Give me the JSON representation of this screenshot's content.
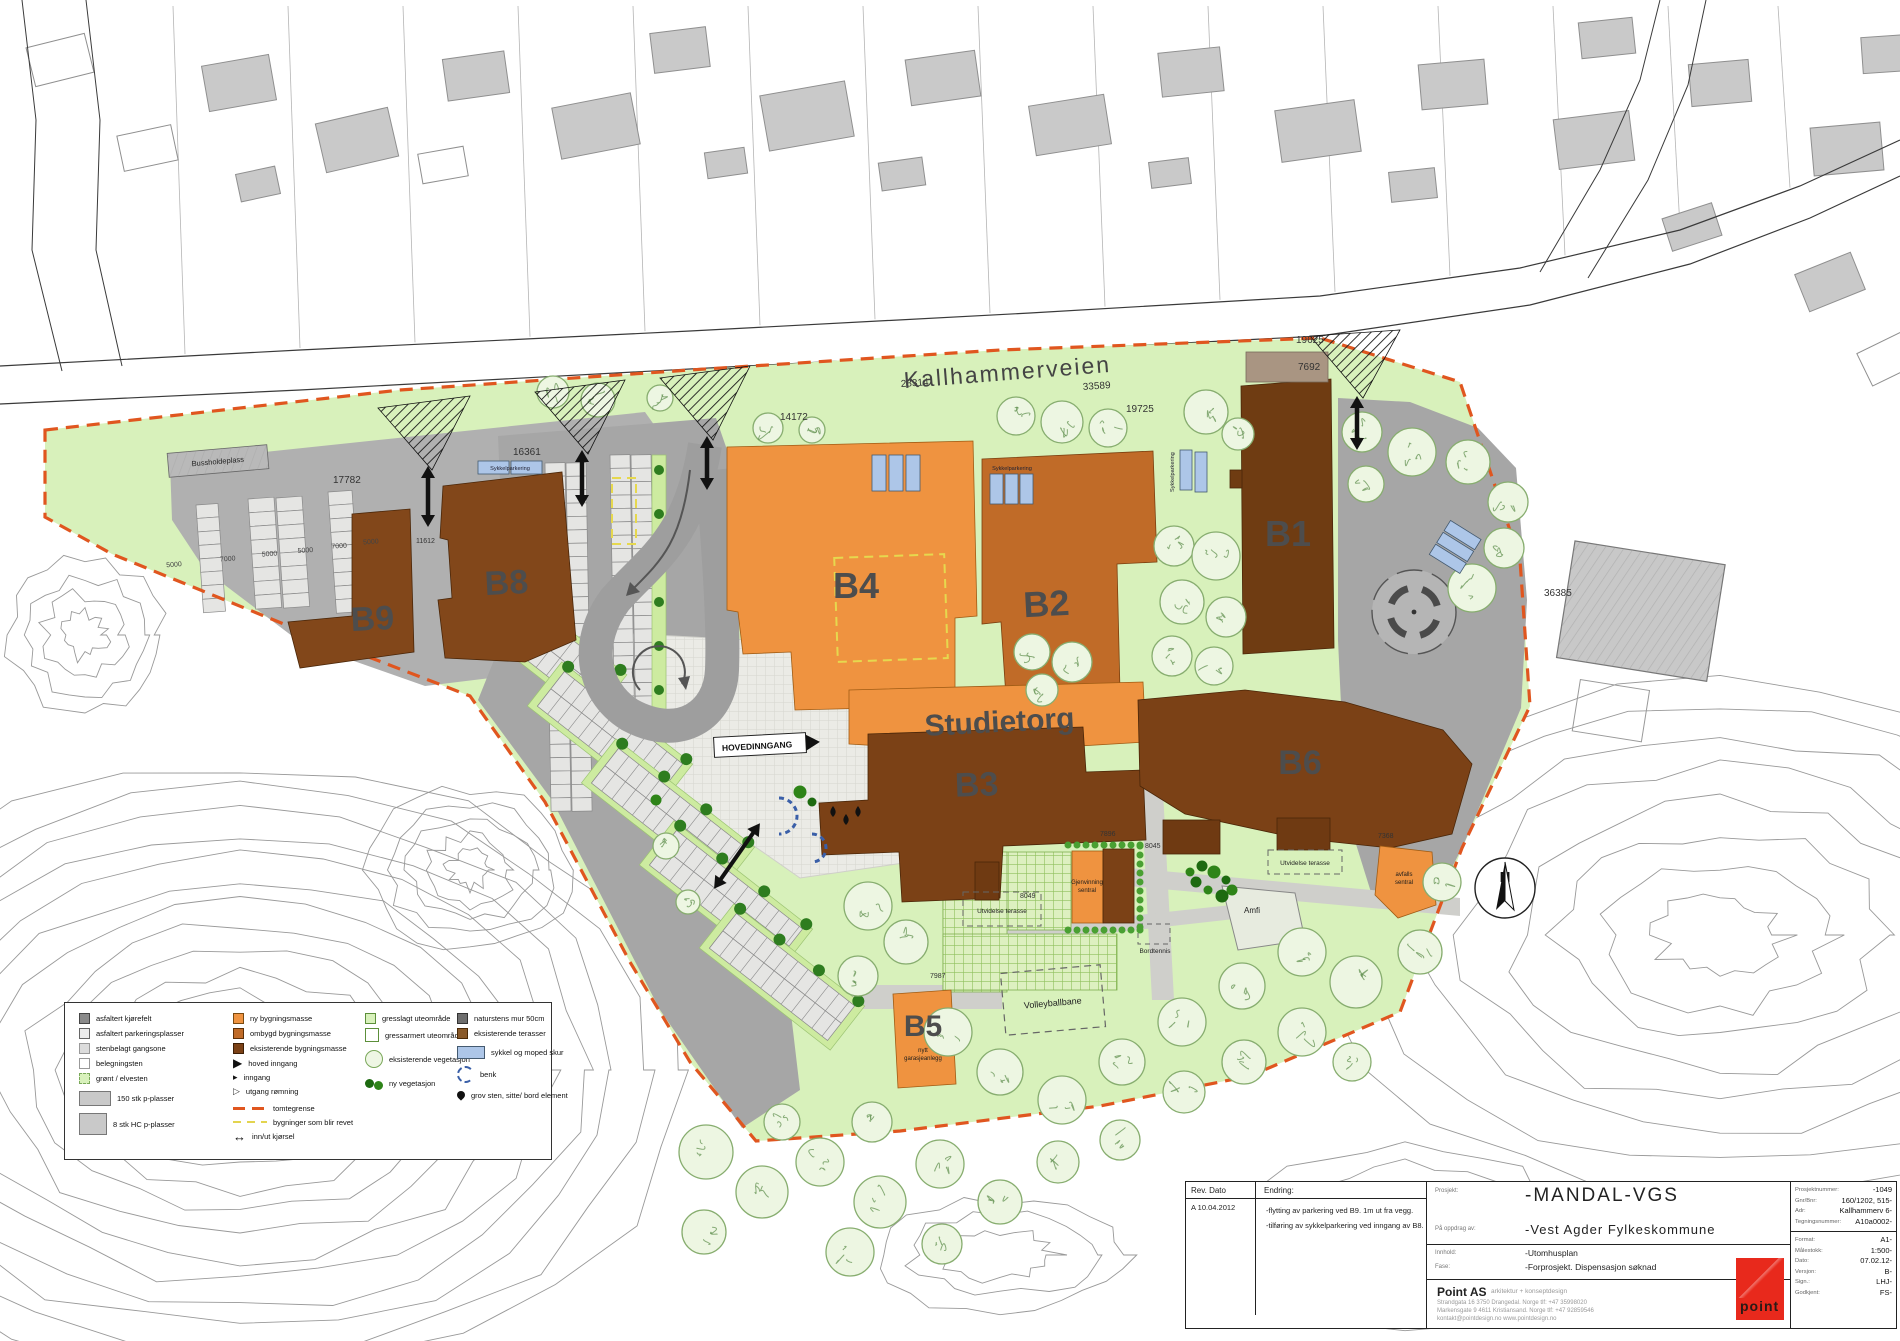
{
  "plan": {
    "street": {
      "name": "Kallhammerveien"
    },
    "dims": {
      "d28314": "28314",
      "d33589": "33589",
      "d19625": "19625",
      "d7692": "7692",
      "d14172": "14172",
      "d19725": "19725",
      "d16361": "16361",
      "d17782": "17782",
      "d11612": "11612",
      "d36385": "36385",
      "d7896": "7896",
      "d8045": "8045",
      "d8049": "8049",
      "d7987": "7987",
      "d7368": "7368",
      "s1": "5000",
      "s2": "7000",
      "s3": "5000",
      "s4": "5000",
      "s5": "7000",
      "s6": "5000"
    },
    "buildings": {
      "b1": "B1",
      "b2": "B2",
      "b3": "B3",
      "b4": "B4",
      "b5": "B5",
      "b6": "B6",
      "b8": "B8",
      "b9": "B9",
      "studietorg": "Studietorg"
    },
    "labels": {
      "hovedinngang": "HOVEDINNGANG",
      "bussholdeplass": "Bussholdeplass",
      "sykkelparkering": "Sykkelparkering",
      "volleyballbane": "Volleyballbane",
      "bordtennis": "Bordtennis",
      "amfi": "Amfi",
      "utvidelse_terasse": "Utvidelse terasse",
      "avfalls1": "avfalls",
      "avfalls2": "sentral",
      "gjenvinning1": "Gjenvinning",
      "gjenvinning2": "sentral",
      "garasje1": "nytt",
      "garasje2": "garasjeanlegg",
      "north": "N"
    },
    "colors": {
      "new_building": "#ef9340",
      "rebuilt_building": "#c06b28",
      "existing_building": "#7b4116",
      "site_green": "#d8f1bb",
      "boundary_orange": "#e0561f",
      "bike_blue": "#adc6e8",
      "logo_red": "#e8291c"
    }
  },
  "legend": {
    "col1": [
      "asfaltert kjørefelt",
      "asfaltert parkeringsplasser",
      "stenbelagt gangsone",
      "belegningsten",
      "grønt / elvesten",
      "150 stk p-plasser",
      "8 stk HC p-plasser"
    ],
    "col2": [
      "ny bygningsmasse",
      "ombygd bygningsmasse",
      "eksisterende bygningsmasse",
      "hoved inngang",
      "inngang",
      "utgang rømning",
      "tomtegrense",
      "bygninger som blir revet",
      "inn/ut kjørsel"
    ],
    "col3": [
      "gresslagt uteområde",
      "gressarmert uteområde",
      "eksisterende vegetasjon",
      "ny vegetasjon"
    ],
    "col4": [
      "naturstens mur 50cm",
      "eksisterende terasser",
      "sykkel og moped skur",
      "benk",
      "grov sten, sitte/ bord element"
    ]
  },
  "titleblock": {
    "revision": {
      "h1": "Rev. Dato",
      "h2": "Endring:",
      "rev_id": "A 10.04.2012",
      "line1": "-flytting av parkering ved B9. 1m ut fra vegg.",
      "line2": "-tilføring av sykkelparkering ved inngang av B8."
    },
    "project_label": "Prosjekt:",
    "project": "-MANDAL-VGS",
    "client_label": "På oppdrag av:",
    "client": "-Vest Agder Fylkeskommune",
    "content_label": "Innhold:",
    "content": "-Utomhusplan",
    "phase_label": "Fase:",
    "phase": "-Forprosjekt. Dispensasjon søknad",
    "firm": {
      "name": "Point AS",
      "tagline": "arkitektur + konseptdesign",
      "addr1": "Strandgata 16 3750 Drangedal. Norge tlf: +47 35998020",
      "addr2": "Markensgate 9 4611 Kristiansand. Norge tlf: +47 92859546",
      "contact": "kontakt@pointdesign.no   www.pointdesign.no",
      "logo": "point"
    },
    "meta1": [
      {
        "label": "Prosjektnummer:",
        "value": "-1049"
      },
      {
        "label": "Gnr/Bnr:",
        "value": "160/1202, 515-"
      },
      {
        "label": "Adr:",
        "value": "Kallhammerv 6-"
      },
      {
        "label": "Tegningsnummer:",
        "value": "A10a0002-"
      }
    ],
    "meta2": [
      {
        "label": "Format:",
        "value": "A1-"
      },
      {
        "label": "Målestokk:",
        "value": "1:500-"
      },
      {
        "label": "Dato:",
        "value": "07.02.12-"
      },
      {
        "label": "Versjon:",
        "value": "B-"
      },
      {
        "label": "Sign.:",
        "value": "LHJ-"
      },
      {
        "label": "Godkjent:",
        "value": "FS-"
      }
    ]
  }
}
